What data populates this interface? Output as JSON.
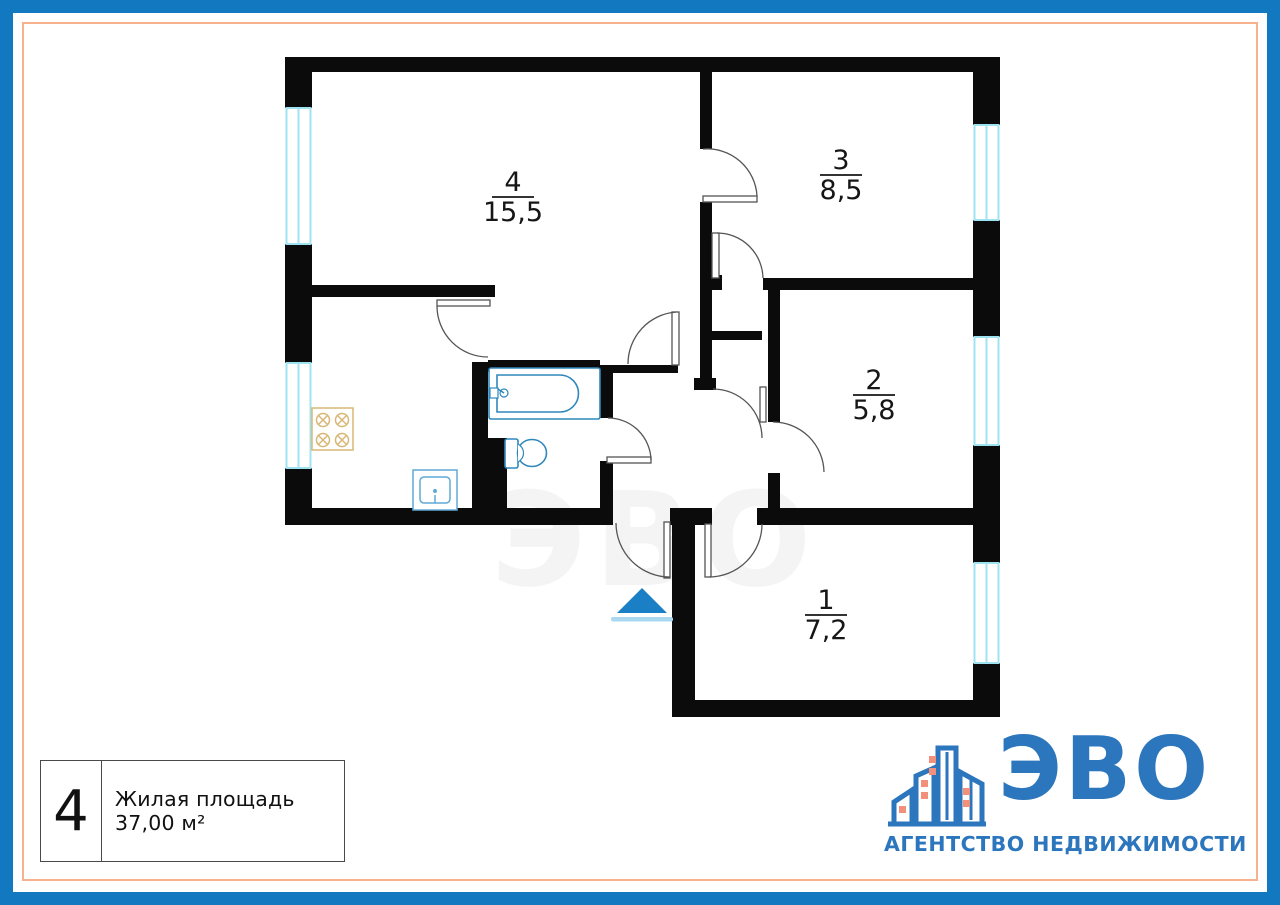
{
  "page": {
    "background": "#FFFFFF",
    "border_color": "#1278BF",
    "accent_border_color": "#F8B18D"
  },
  "floor_plan": {
    "wall_color": "#0B0B0B",
    "window_color": "#9FE3F0",
    "door_color": "#555555",
    "fixture_color": "#2F88BD",
    "stove_color": "#D8B776",
    "watermark": "ЭВО",
    "entrance": {
      "arrow_color": "#1A7FC5",
      "underline_color": "#A9D8F0"
    },
    "rooms": [
      {
        "number": "1",
        "area": "7,2"
      },
      {
        "number": "2",
        "area": "5,8"
      },
      {
        "number": "3",
        "area": "8,5"
      },
      {
        "number": "4",
        "area": "15,5"
      }
    ]
  },
  "legend": {
    "flat_number": "4",
    "label": "Жилая площадь 37,00 м²"
  },
  "logo": {
    "name": "ЭВО",
    "tagline": "АГЕНТСТВО НЕДВИЖИМОСТИ",
    "brand_color": "#2B76BC",
    "window_color": "#F2907B"
  }
}
